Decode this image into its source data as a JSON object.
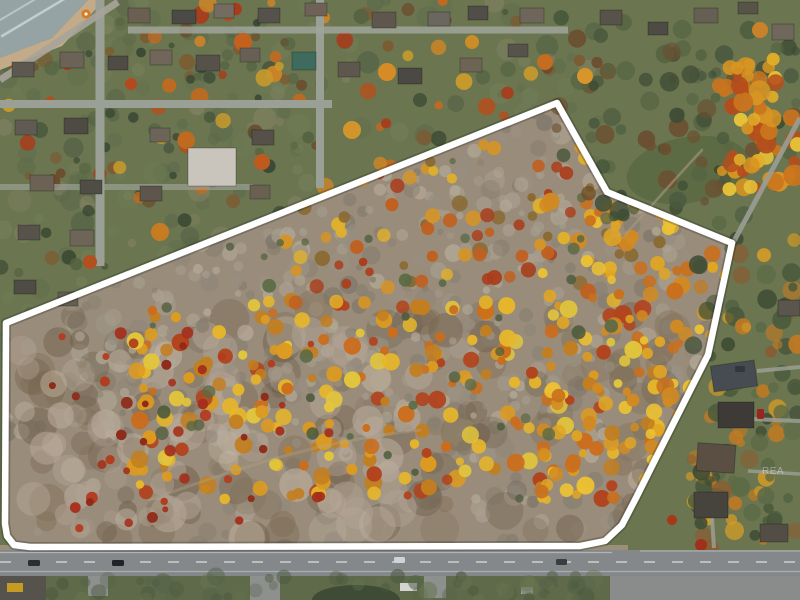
{
  "meta": {
    "width": 800,
    "height": 600,
    "type": "aerial-drone-photo",
    "subject": "autumn wooded land parcel outlined in white beside lakefront residential neighborhood and road frontage"
  },
  "watermark": {
    "text": "REA",
    "color": "#ffffff",
    "opacity": 0.38
  },
  "scene": {
    "base_color": "#6b7651",
    "boundary": {
      "color": "#ffffff",
      "width": 6.5,
      "shadow_color": "rgba(25,25,25,0.25)",
      "shadow_width": 10,
      "points": [
        [
          6,
          323
        ],
        [
          557,
          103
        ],
        [
          607,
          192
        ],
        [
          732,
          243
        ],
        [
          708,
          355
        ],
        [
          655,
          460
        ],
        [
          636,
          498
        ],
        [
          622,
          525
        ],
        [
          605,
          541
        ],
        [
          580,
          546
        ],
        [
          30,
          547
        ],
        [
          14,
          545
        ],
        [
          7,
          536
        ],
        [
          5,
          524
        ]
      ]
    },
    "parcel_fill": "#998c7a",
    "regions_pre": [
      {
        "name": "lake-water",
        "type": "poly",
        "points": [
          [
            0,
            0
          ],
          [
            88,
            0
          ],
          [
            52,
            38
          ],
          [
            0,
            58
          ]
        ],
        "fill": "#96a3a4",
        "opacity": 1
      },
      {
        "name": "beach-sand",
        "type": "poly",
        "points": [
          [
            104,
            0
          ],
          [
            62,
            46
          ],
          [
            0,
            70
          ],
          [
            0,
            58
          ],
          [
            52,
            38
          ],
          [
            88,
            0
          ]
        ],
        "fill": "#c3aa88",
        "opacity": 1
      }
    ],
    "regions_mid": [
      {
        "name": "road-shoulder",
        "type": "rect",
        "x": 0,
        "y": 545,
        "w": 628,
        "h": 6,
        "fill": "#a0937e",
        "opacity": 0.9
      },
      {
        "name": "meadow-clearing",
        "type": "ellipse",
        "cx": 688,
        "cy": 170,
        "rx": 62,
        "ry": 33,
        "rot": -10,
        "fill": "#5d6b45",
        "opacity": 1
      }
    ],
    "regions_post": [
      {
        "name": "roadside-grass",
        "type": "rect",
        "x": 0,
        "y": 576,
        "w": 800,
        "h": 24,
        "fill": "#5e6a49",
        "opacity": 1
      },
      {
        "name": "corner-pavement",
        "type": "rect",
        "x": 0,
        "y": 576,
        "w": 46,
        "h": 24,
        "fill": "#56534d",
        "opacity": 1
      },
      {
        "name": "driveway-stub",
        "type": "rect",
        "x": 88,
        "y": 576,
        "w": 20,
        "h": 20,
        "fill": "#8e908e",
        "opacity": 1
      },
      {
        "name": "side-street",
        "type": "rect",
        "x": 250,
        "y": 576,
        "w": 30,
        "h": 24,
        "fill": "#8e908e",
        "opacity": 1
      },
      {
        "name": "driveway-stub",
        "type": "rect",
        "x": 424,
        "y": 576,
        "w": 22,
        "h": 22,
        "fill": "#8e908e",
        "opacity": 1
      },
      {
        "name": "parking-pavement",
        "type": "rect",
        "x": 610,
        "y": 576,
        "w": 190,
        "h": 24,
        "fill": "#8a8c8b",
        "opacity": 1
      },
      {
        "name": "landscape-hedge",
        "type": "ellipse",
        "cx": 356,
        "cy": 600,
        "rx": 44,
        "ry": 15,
        "rot": 0,
        "fill": "#3e4c36",
        "opacity": 1
      },
      {
        "name": "white-trailer",
        "type": "rect",
        "x": 400,
        "y": 583,
        "w": 17,
        "h": 8,
        "fill": "#d4d4d1",
        "opacity": 1
      },
      {
        "name": "parked-car",
        "type": "rect",
        "x": 521,
        "y": 587,
        "w": 12,
        "h": 7,
        "fill": "#9aa0a2",
        "opacity": 1
      },
      {
        "name": "yellow-equipment",
        "type": "rect",
        "x": 7,
        "y": 583,
        "w": 16,
        "h": 9,
        "fill": "#c59b24",
        "opacity": 1
      }
    ],
    "clusters": [
      {
        "name": "lawn-mottle",
        "group": "a",
        "rect": [
          0,
          0,
          600,
          345
        ],
        "count": 260,
        "rmin": 4,
        "rmax": 12,
        "omin": 0.25,
        "omax": 0.6,
        "seed": 11,
        "colors": [
          "#5c6a48",
          "#6e7c54",
          "#4e5c42",
          "#76825c",
          "#8a8468",
          "#5a684a"
        ]
      },
      {
        "name": "yard-trees",
        "group": "a",
        "rect": [
          0,
          0,
          600,
          340
        ],
        "count": 150,
        "rmin": 3,
        "rmax": 8,
        "omin": 0.6,
        "omax": 0.95,
        "seed": 21,
        "colors": [
          "#44523a",
          "#3c4a34",
          "#556342",
          "#6b4a2a",
          "#7d5a30",
          "#394733"
        ]
      },
      {
        "name": "yard-autumn-trees",
        "group": "a",
        "rect": [
          0,
          0,
          580,
          200
        ],
        "count": 55,
        "rmin": 4,
        "rmax": 9,
        "omin": 0.8,
        "omax": 1,
        "seed": 31,
        "colors": [
          "#c06a20",
          "#cd8426",
          "#b1501e",
          "#c79a2c",
          "#a83c1c"
        ]
      },
      {
        "name": "field-trees",
        "group": "b",
        "rect": [
          556,
          16,
          244,
          210
        ],
        "count": 95,
        "rmin": 4,
        "rmax": 10,
        "omin": 0.6,
        "omax": 0.95,
        "seed": 41,
        "colors": [
          "#3f4d35",
          "#4a5a3e",
          "#566442",
          "#6b4f30"
        ]
      },
      {
        "name": "corner-autumn-grove",
        "group": "b",
        "rect": [
          718,
          58,
          82,
          132
        ],
        "count": 60,
        "rmin": 5,
        "rmax": 11,
        "omin": 0.85,
        "omax": 1,
        "seed": 51,
        "colors": [
          "#d89422",
          "#e3ae28",
          "#c9741e",
          "#b54e1c",
          "#e6c238"
        ]
      },
      {
        "name": "roadside-trees-east",
        "group": "b",
        "rect": [
          688,
          238,
          112,
          312
        ],
        "count": 110,
        "rmin": 4,
        "rmax": 10,
        "omin": 0.6,
        "omax": 0.95,
        "seed": 61,
        "colors": [
          "#4a5a3c",
          "#5b6a46",
          "#c07a22",
          "#d09a28",
          "#8a5c30",
          "#3f4d35"
        ]
      },
      {
        "name": "scrub-texture",
        "group": "p",
        "rect": [
          0,
          100,
          740,
          450
        ],
        "count": 420,
        "rmin": 4,
        "rmax": 11,
        "omin": 0.35,
        "omax": 0.8,
        "seed": 71,
        "colors": [
          "#8f8679",
          "#9d9486",
          "#a99f90",
          "#7e766a",
          "#b3a896",
          "#867d6e"
        ]
      },
      {
        "name": "scrub-brown-patches",
        "group": "p",
        "rect": [
          30,
          300,
          650,
          240
        ],
        "count": 120,
        "rmin": 8,
        "rmax": 20,
        "omin": 0.25,
        "omax": 0.5,
        "seed": 81,
        "colors": [
          "#74644f",
          "#806e56",
          "#6a5a46"
        ]
      },
      {
        "name": "dry-grass-patches",
        "group": "p",
        "rect": [
          20,
          330,
          400,
          210
        ],
        "count": 80,
        "rmin": 8,
        "rmax": 20,
        "omin": 0.3,
        "omax": 0.55,
        "seed": 91,
        "colors": [
          "#bdafa0",
          "#c4b6a2",
          "#b2a394"
        ]
      },
      {
        "name": "bare-gray-trees",
        "group": "p",
        "rect": [
          60,
          120,
          650,
          330
        ],
        "count": 300,
        "rmin": 3,
        "rmax": 8,
        "omin": 0.5,
        "omax": 0.9,
        "seed": 101,
        "colors": [
          "#978e80",
          "#a59c8d",
          "#888071",
          "#b1a795"
        ]
      },
      {
        "name": "autumn-canopy-mid",
        "group": "p",
        "rect": [
          130,
          300,
          530,
          200
        ],
        "count": 240,
        "rmin": 4,
        "rmax": 9,
        "omin": 0.85,
        "omax": 1,
        "seed": 111,
        "colors": [
          "#dd9b20",
          "#e7b62a",
          "#cb6d1c",
          "#b2431d",
          "#e2c53c",
          "#c27e20"
        ]
      },
      {
        "name": "autumn-canopy-upper",
        "group": "p",
        "rect": [
          280,
          130,
          400,
          180
        ],
        "count": 110,
        "rmin": 4,
        "rmax": 8,
        "omin": 0.8,
        "omax": 1,
        "seed": 121,
        "colors": [
          "#d59426",
          "#c06020",
          "#e0b02c",
          "#a93e1c",
          "#8a6a32"
        ]
      },
      {
        "name": "autumn-canopy-east",
        "group": "p",
        "rect": [
          540,
          200,
          190,
          300
        ],
        "count": 120,
        "rmin": 4,
        "rmax": 9,
        "omin": 0.85,
        "omax": 1,
        "seed": 131,
        "colors": [
          "#e0a524",
          "#ecc133",
          "#c9701d",
          "#d18a22"
        ]
      },
      {
        "name": "red-shrubs",
        "group": "p",
        "rect": [
          50,
          330,
          280,
          200
        ],
        "count": 45,
        "rmin": 3,
        "rmax": 6,
        "omin": 0.9,
        "omax": 1,
        "seed": 141,
        "colors": [
          "#a5301c",
          "#b33c20",
          "#8f2a18"
        ]
      },
      {
        "name": "evergreen-sprinkle",
        "group": "p",
        "rect": [
          150,
          150,
          500,
          350
        ],
        "count": 50,
        "rmin": 3,
        "rmax": 7,
        "omin": 0.7,
        "omax": 0.95,
        "seed": 151,
        "colors": [
          "#4e5c3c",
          "#5a6a44"
        ]
      },
      {
        "name": "roadside-grass-mottle",
        "group": "c",
        "rect": [
          46,
          576,
          560,
          24
        ],
        "count": 60,
        "rmin": 4,
        "rmax": 10,
        "omin": 0.3,
        "omax": 0.6,
        "seed": 161,
        "colors": [
          "#55644a",
          "#677550",
          "#49573f"
        ]
      }
    ],
    "streets_a": [
      [
        100,
        0,
        100,
        266,
        9,
        "#9aa095",
        1
      ],
      [
        320,
        0,
        320,
        188,
        8,
        "#9aa095",
        1
      ],
      [
        0,
        104,
        332,
        104,
        8,
        "#9aa095",
        1
      ],
      [
        128,
        30,
        568,
        30,
        7,
        "#a0a59a",
        0.85
      ],
      [
        0,
        187,
        253,
        187,
        6,
        "#9aa095",
        0.7
      ],
      [
        0,
        80,
        118,
        2,
        7,
        "#a8a59b",
        0.9
      ]
    ],
    "streets_b": [
      [
        733,
        243,
        800,
        118,
        5,
        "#9b9e95",
        0.9
      ],
      [
        757,
        371,
        800,
        367,
        4,
        "#9b9e95",
        0.85
      ],
      [
        751,
        419,
        800,
        421,
        4,
        "#9b9e95",
        0.85
      ],
      [
        748,
        471,
        800,
        474,
        3.5,
        "#9b9e95",
        0.8
      ],
      [
        712,
        518,
        714,
        548,
        4,
        "#9b9e95",
        0.85
      ]
    ],
    "paths": [
      {
        "name": "meadow-trail",
        "d": "M 622 238 C 650 208 672 182 702 150",
        "color": "#a79a7e",
        "w": 2.5,
        "o": 0.6
      },
      {
        "name": "surf-line",
        "d": "M 2 36 L 66 -2",
        "color": "#e9eff1",
        "w": 2.5,
        "o": 0.55
      },
      {
        "name": "surf-line",
        "d": "M 0 20 L 44 -6",
        "color": "#dfe7ea",
        "w": 2,
        "o": 0.5
      },
      {
        "name": "brush-trail",
        "d": "M 150 500 C 260 460 330 440 420 430",
        "color": "#b3a58d",
        "w": 3,
        "o": 0.35
      }
    ],
    "feature_trees": [
      [
        243,
        42,
        9,
        "#c3611f"
      ],
      [
        302,
        62,
        7,
        "#cd7d22"
      ],
      [
        387,
        72,
        9,
        "#d58c26"
      ],
      [
        131,
        84,
        6,
        "#b24a1e"
      ],
      [
        472,
        42,
        7,
        "#cb8d28"
      ],
      [
        545,
        62,
        8,
        "#c46c1f"
      ],
      [
        352,
        130,
        9,
        "#d2952b"
      ],
      [
        262,
        162,
        8,
        "#bf5a1e"
      ],
      [
        160,
        232,
        9,
        "#c77c22"
      ],
      [
        90,
        262,
        7,
        "#b25020"
      ],
      [
        585,
        76,
        8,
        "#d8962a"
      ],
      [
        760,
        30,
        8,
        "#c9812a"
      ],
      [
        701,
        545,
        6,
        "#a1301a"
      ],
      [
        672,
        520,
        5,
        "#a83618"
      ],
      [
        40,
        130,
        8,
        "#4e5c40"
      ],
      [
        420,
        100,
        7,
        "#46543a"
      ]
    ],
    "umbrella": {
      "cx": 86,
      "cy": 14,
      "r": 4.5,
      "fill": "#d97a1e",
      "dot": "#f2f2ee"
    },
    "road": {
      "y": 550,
      "h": 26,
      "fill": "#85888a",
      "lines": [
        {
          "x1": 0,
          "y1": 552.5,
          "x2": 612,
          "y2": 552.5,
          "w": 1.3,
          "color": "#d7d9d8",
          "o": 0.55
        },
        {
          "x1": 0,
          "y1": 562,
          "x2": 800,
          "y2": 562,
          "w": 1.6,
          "color": "#e2e3e2",
          "o": 0.8,
          "dash": "11 17"
        },
        {
          "x1": 0,
          "y1": 571.5,
          "x2": 800,
          "y2": 571.5,
          "w": 1.3,
          "color": "#cfd1d0",
          "o": 0.5
        },
        {
          "x1": 640,
          "y1": 551,
          "x2": 800,
          "y2": 551,
          "w": 1.2,
          "color": "#d7d9d8",
          "o": 0.45
        }
      ]
    },
    "houses": [
      [
        128,
        8,
        22,
        15,
        "#6b5f52",
        0
      ],
      [
        172,
        10,
        24,
        14,
        "#4c4a46",
        0
      ],
      [
        214,
        4,
        20,
        14,
        "#746c60",
        0
      ],
      [
        258,
        8,
        22,
        15,
        "#55514b",
        0
      ],
      [
        305,
        3,
        22,
        13,
        "#6e6257",
        0
      ],
      [
        372,
        12,
        24,
        16,
        "#5f574d",
        0
      ],
      [
        428,
        12,
        22,
        14,
        "#6b675f",
        0
      ],
      [
        468,
        6,
        20,
        14,
        "#514d48",
        0
      ],
      [
        520,
        8,
        24,
        15,
        "#6e665a",
        0
      ],
      [
        600,
        10,
        22,
        15,
        "#57524a",
        0
      ],
      [
        648,
        22,
        20,
        13,
        "#4e4a44",
        0
      ],
      [
        694,
        8,
        24,
        15,
        "#665f54",
        0
      ],
      [
        738,
        2,
        20,
        12,
        "#585349",
        0
      ],
      [
        772,
        24,
        22,
        16,
        "#6f675c",
        0
      ],
      [
        12,
        62,
        22,
        15,
        "#5c5850",
        0
      ],
      [
        60,
        52,
        24,
        16,
        "#6b6356",
        0
      ],
      [
        108,
        56,
        20,
        14,
        "#4f4b45",
        0
      ],
      [
        150,
        50,
        22,
        15,
        "#706659",
        0
      ],
      [
        196,
        55,
        24,
        16,
        "#565249",
        0
      ],
      [
        240,
        48,
        20,
        14,
        "#686054",
        0
      ],
      [
        292,
        52,
        24,
        18,
        "#3e6b5e",
        0
      ],
      [
        338,
        62,
        22,
        15,
        "#5d574e",
        0
      ],
      [
        398,
        68,
        24,
        16,
        "#4c4843",
        0
      ],
      [
        460,
        58,
        22,
        14,
        "#6e6455",
        0
      ],
      [
        508,
        44,
        20,
        13,
        "#57534c",
        0
      ],
      [
        15,
        120,
        22,
        15,
        "#5f5b53",
        0
      ],
      [
        64,
        118,
        24,
        16,
        "#4e4a44",
        0
      ],
      [
        150,
        128,
        20,
        14,
        "#6c6458",
        0
      ],
      [
        188,
        148,
        48,
        38,
        "#c9c5bd",
        0
      ],
      [
        252,
        130,
        22,
        15,
        "#565148",
        0
      ],
      [
        30,
        175,
        24,
        16,
        "#6b6154",
        0
      ],
      [
        80,
        180,
        22,
        14,
        "#504c46",
        0
      ],
      [
        140,
        186,
        22,
        15,
        "#5e564c",
        0
      ],
      [
        250,
        185,
        20,
        14,
        "#6a6052",
        0
      ],
      [
        18,
        225,
        22,
        15,
        "#57534b",
        0
      ],
      [
        70,
        230,
        24,
        16,
        "#6d6557",
        0
      ],
      [
        14,
        280,
        22,
        14,
        "#4f4b45",
        0
      ],
      [
        58,
        292,
        20,
        14,
        "#665e52",
        0
      ],
      [
        712,
        363,
        44,
        26,
        "#474b52",
        -8
      ],
      [
        718,
        402,
        36,
        26,
        "#3e3b37",
        0
      ],
      [
        697,
        444,
        38,
        28,
        "#5a4f42",
        4
      ],
      [
        694,
        492,
        34,
        26,
        "#47433d",
        0
      ],
      [
        778,
        300,
        22,
        16,
        "#5a554d",
        0
      ],
      [
        760,
        524,
        28,
        18,
        "#524d45",
        0
      ]
    ],
    "cars": [
      [
        28,
        560,
        12,
        6,
        "#2b2d31"
      ],
      [
        112,
        560,
        12,
        6,
        "#202328"
      ],
      [
        394,
        557,
        11,
        6,
        "#d0d3d4"
      ],
      [
        556,
        559,
        11,
        6,
        "#3a3d42"
      ],
      [
        757,
        409,
        7,
        10,
        "#9c2420"
      ],
      [
        735,
        366,
        10,
        6,
        "#33363a"
      ]
    ]
  }
}
